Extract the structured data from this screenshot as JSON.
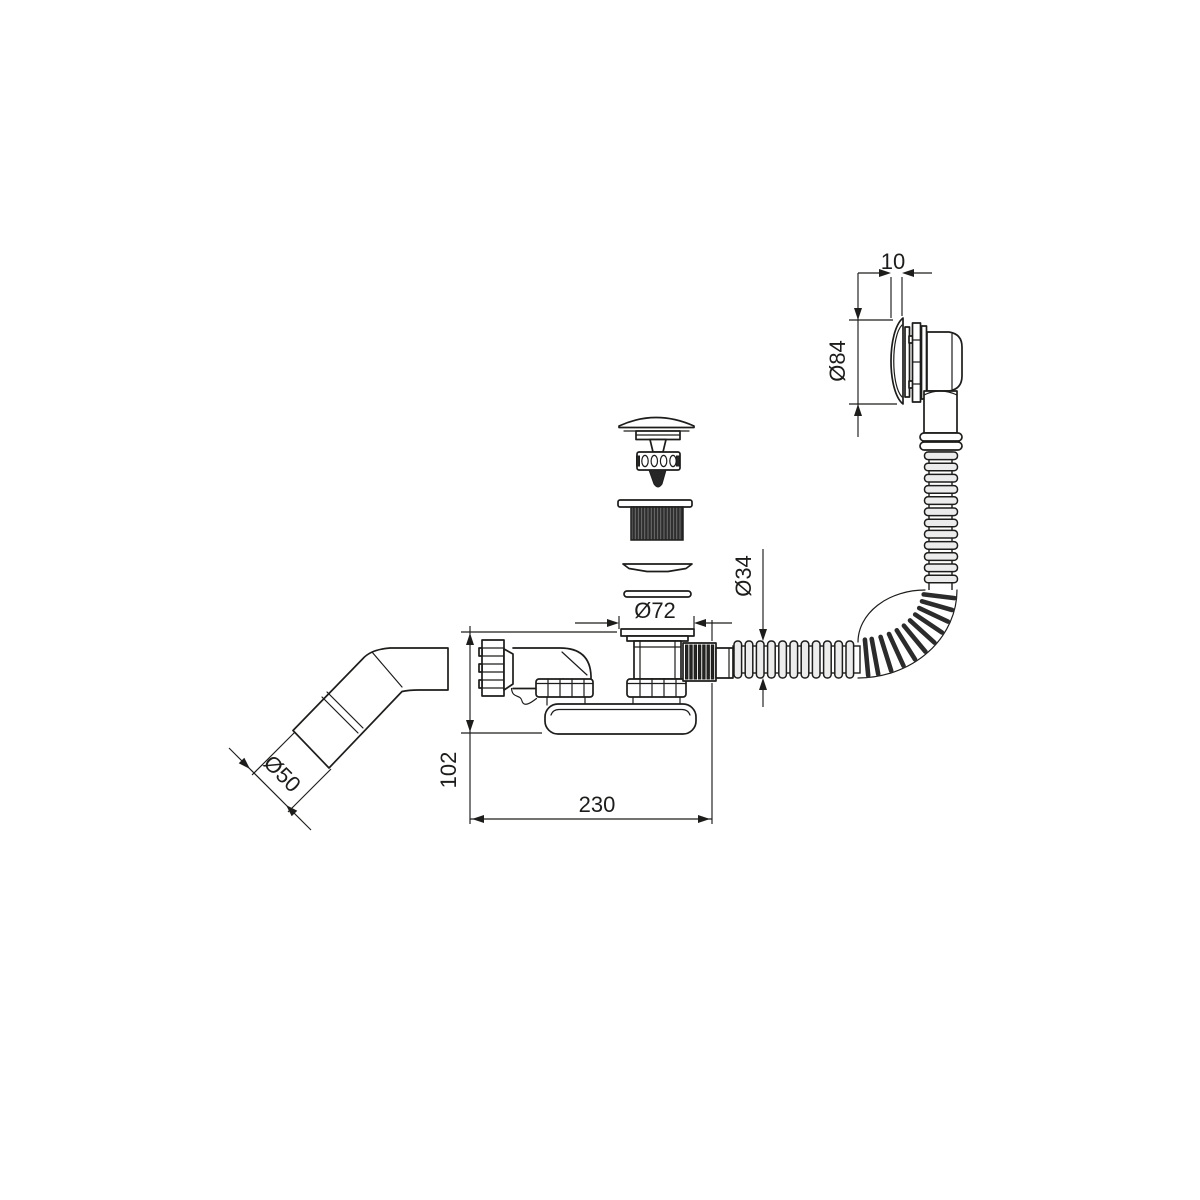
{
  "drawing": {
    "colors": {
      "background": "#ffffff",
      "line": "#1d1d1b",
      "rib_fill": "#ececec",
      "dark_fill": "#262626"
    },
    "dimensions": {
      "cap_offset": {
        "label": "10"
      },
      "cap_diameter": {
        "label": "Ø84"
      },
      "hose_diameter": {
        "label": "Ø34"
      },
      "flange_diameter": {
        "label": "Ø72"
      },
      "outlet_diameter": {
        "label": "Ø50"
      },
      "height": {
        "label": "102"
      },
      "length": {
        "label": "230"
      }
    }
  }
}
